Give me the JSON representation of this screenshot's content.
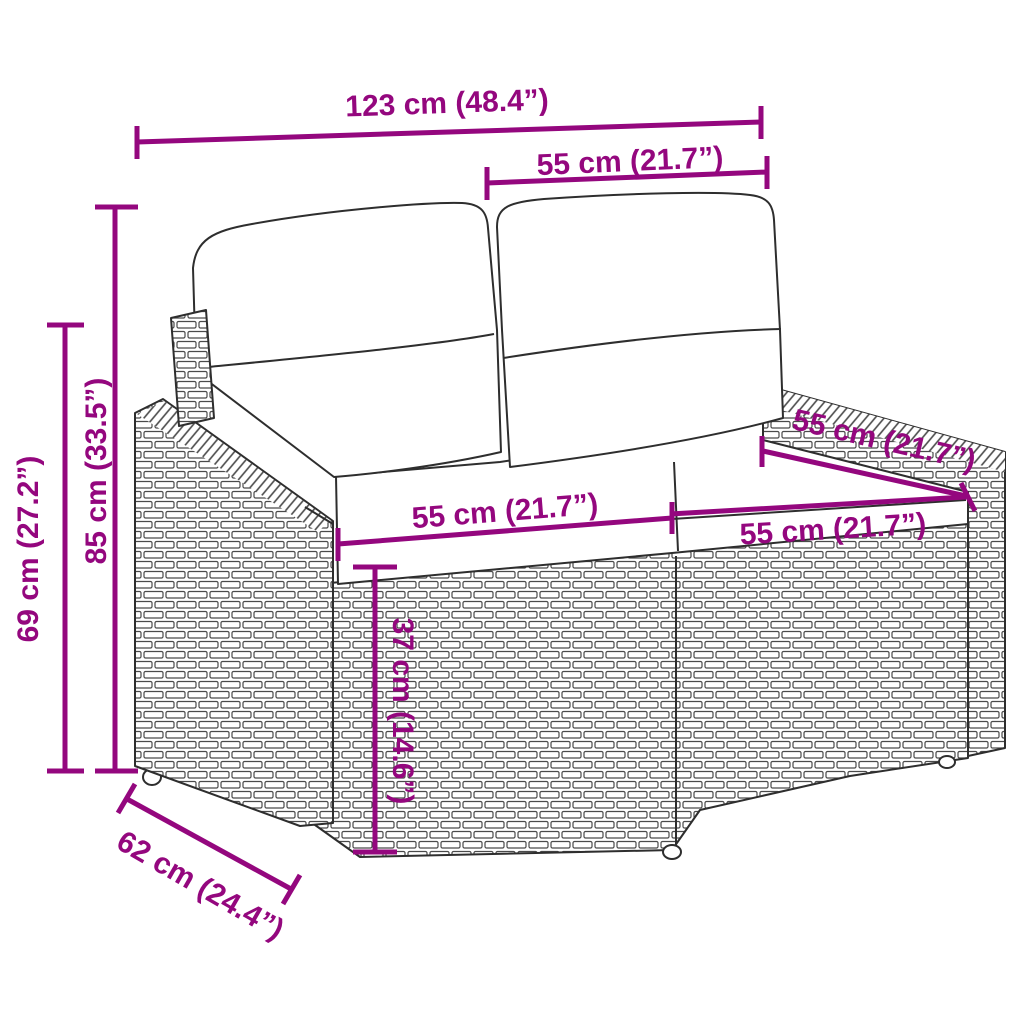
{
  "diagram": {
    "title": "Rattan garden loveseat dimension diagram",
    "accent_color": "#94077E",
    "outline_color": "#2E2E2E",
    "dimensions": {
      "total_width": "123 cm (48.4”)",
      "backrest_section_width": "55 cm (21.7”)",
      "total_height": "85 cm (33.5”)",
      "armrest_height": "69 cm (27.2”)",
      "armrest_top_depth": "55 cm (21.7”)",
      "left_seat_width": "55 cm (21.7”)",
      "right_seat_width": "55 cm (21.7”)",
      "seat_height": "37 cm (14.6”)",
      "total_depth": "62 cm (24.4”)"
    }
  }
}
